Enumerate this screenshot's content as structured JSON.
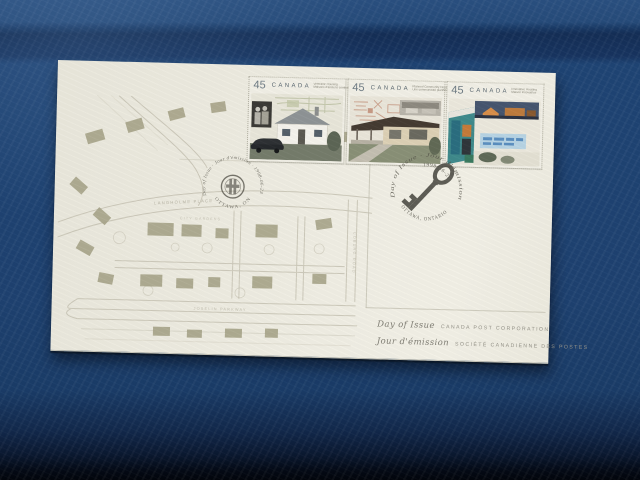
{
  "photo": {
    "subject": "first-day-cover-envelope-on-blue-fabric",
    "colors": {
      "background_blue": "#1e4170",
      "envelope_cream": "#efede2",
      "map_olive": "#a8a58a",
      "map_line": "#c7c3b4",
      "postmark_ink": "#4e4d44"
    }
  },
  "envelope": {
    "stamps": [
      {
        "denomination": "45",
        "country": "CANADA",
        "caption_line1": "Veterans' Housing",
        "caption_line2": "Maisons d'anciens combattants"
      },
      {
        "denomination": "45",
        "country": "CANADA",
        "caption_line1": "Planned Community Housing",
        "caption_line2": "Une communauté planifiée"
      },
      {
        "denomination": "45",
        "country": "CANADA",
        "caption_line1": "Innovative Housing",
        "caption_line2": "Maison innovatrice"
      }
    ],
    "postmarks": {
      "left": {
        "arc_top": "Day of Issue · Jour d'émission · 1998-06-23",
        "arc_bottom": "OTTAWA, ONTARIO"
      },
      "right": {
        "arc_top": "Day of Issue · Jour d'émission",
        "date": "1998-06-23",
        "arc_bottom": "OTTAWA, ONTARIO"
      }
    },
    "map_labels": {
      "street1": "LANGHOLME PLACE",
      "street2": "CITY GARDENS",
      "street3": "COBURG ROAD",
      "street4": "JOSELIN PARKWAY"
    },
    "bottom_text": {
      "line1_left": "Day of Issue",
      "line1_right": "CANADA POST CORPORATION",
      "line2_left": "Jour d'émission",
      "line2_right": "SOCIÉTÉ CANADIENNE DES POSTES"
    }
  }
}
